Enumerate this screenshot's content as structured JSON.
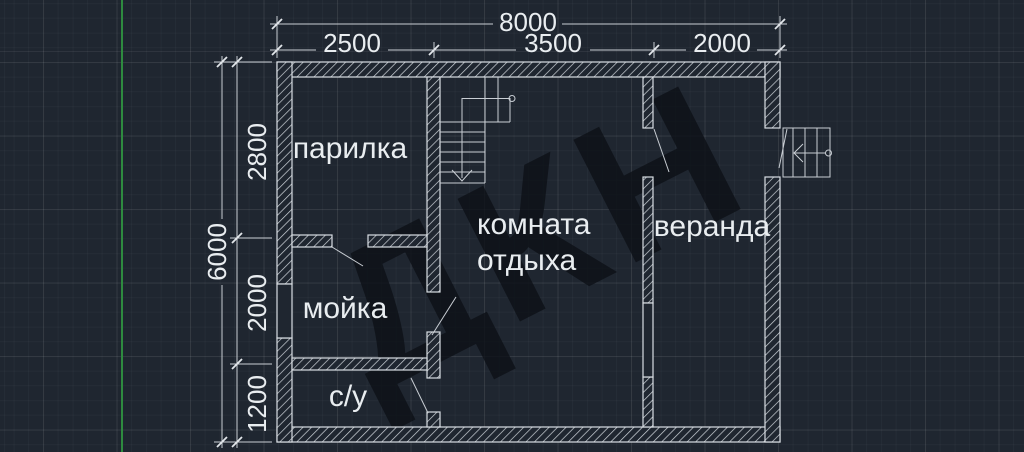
{
  "watermark": {
    "text": "ДКН"
  },
  "rooms": {
    "parilka": "парилка",
    "moyka": "мойка",
    "su": "с/у",
    "lounge_line1": "комната",
    "lounge_line2": "отдыха",
    "veranda": "веранда"
  },
  "dimensions": {
    "top": {
      "overall": "8000",
      "seg1": "2500",
      "seg2": "3500",
      "seg3": "2000"
    },
    "left": {
      "overall": "6000",
      "seg1": "2800",
      "seg2": "2000",
      "seg3": "1200"
    }
  },
  "colors": {
    "background": "#1f2630",
    "line": "#d9dee3",
    "text": "#e9edf0",
    "axis_green": "#2e8b3f",
    "watermark": "#11151b"
  }
}
